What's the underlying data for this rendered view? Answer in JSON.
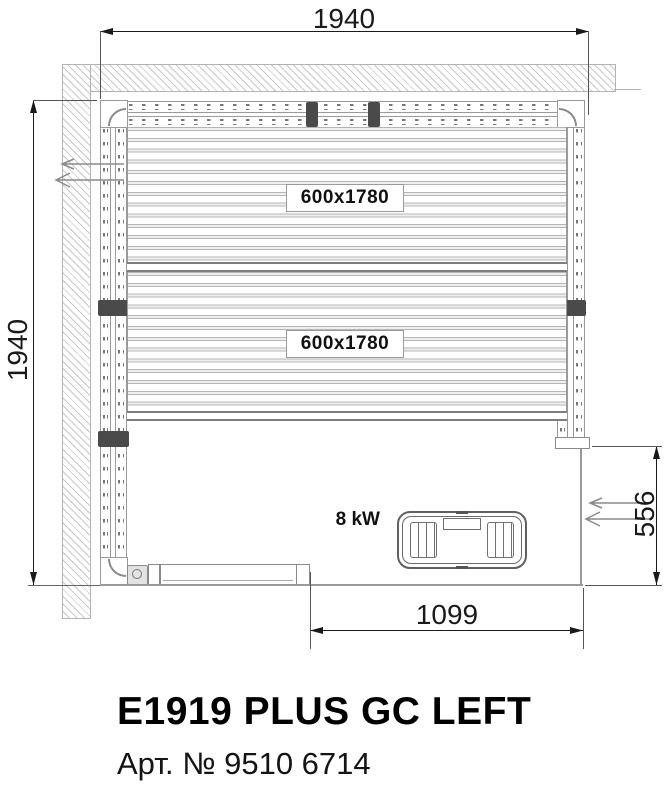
{
  "drawing": {
    "dimensions": {
      "overall_width": "1940",
      "overall_depth": "1940",
      "door_opening": "556",
      "front_opening": "1099"
    },
    "benches": {
      "upper_label": "600x1780",
      "lower_label": "600x1780"
    },
    "heater": {
      "label": "8 kW"
    },
    "icons": {
      "airflow_left": "airflow-arrows-icon",
      "airflow_door": "door-airflow-arrows-icon"
    },
    "colors": {
      "line_gray": "#9a9a9a",
      "dim_black": "#1a1a1a",
      "hatch_gray": "#c9c9c9",
      "stud_dark": "#4a4a4a"
    }
  },
  "footer": {
    "title": "E1919 PLUS GC LEFT",
    "article": "Арт. № 9510 6714"
  }
}
